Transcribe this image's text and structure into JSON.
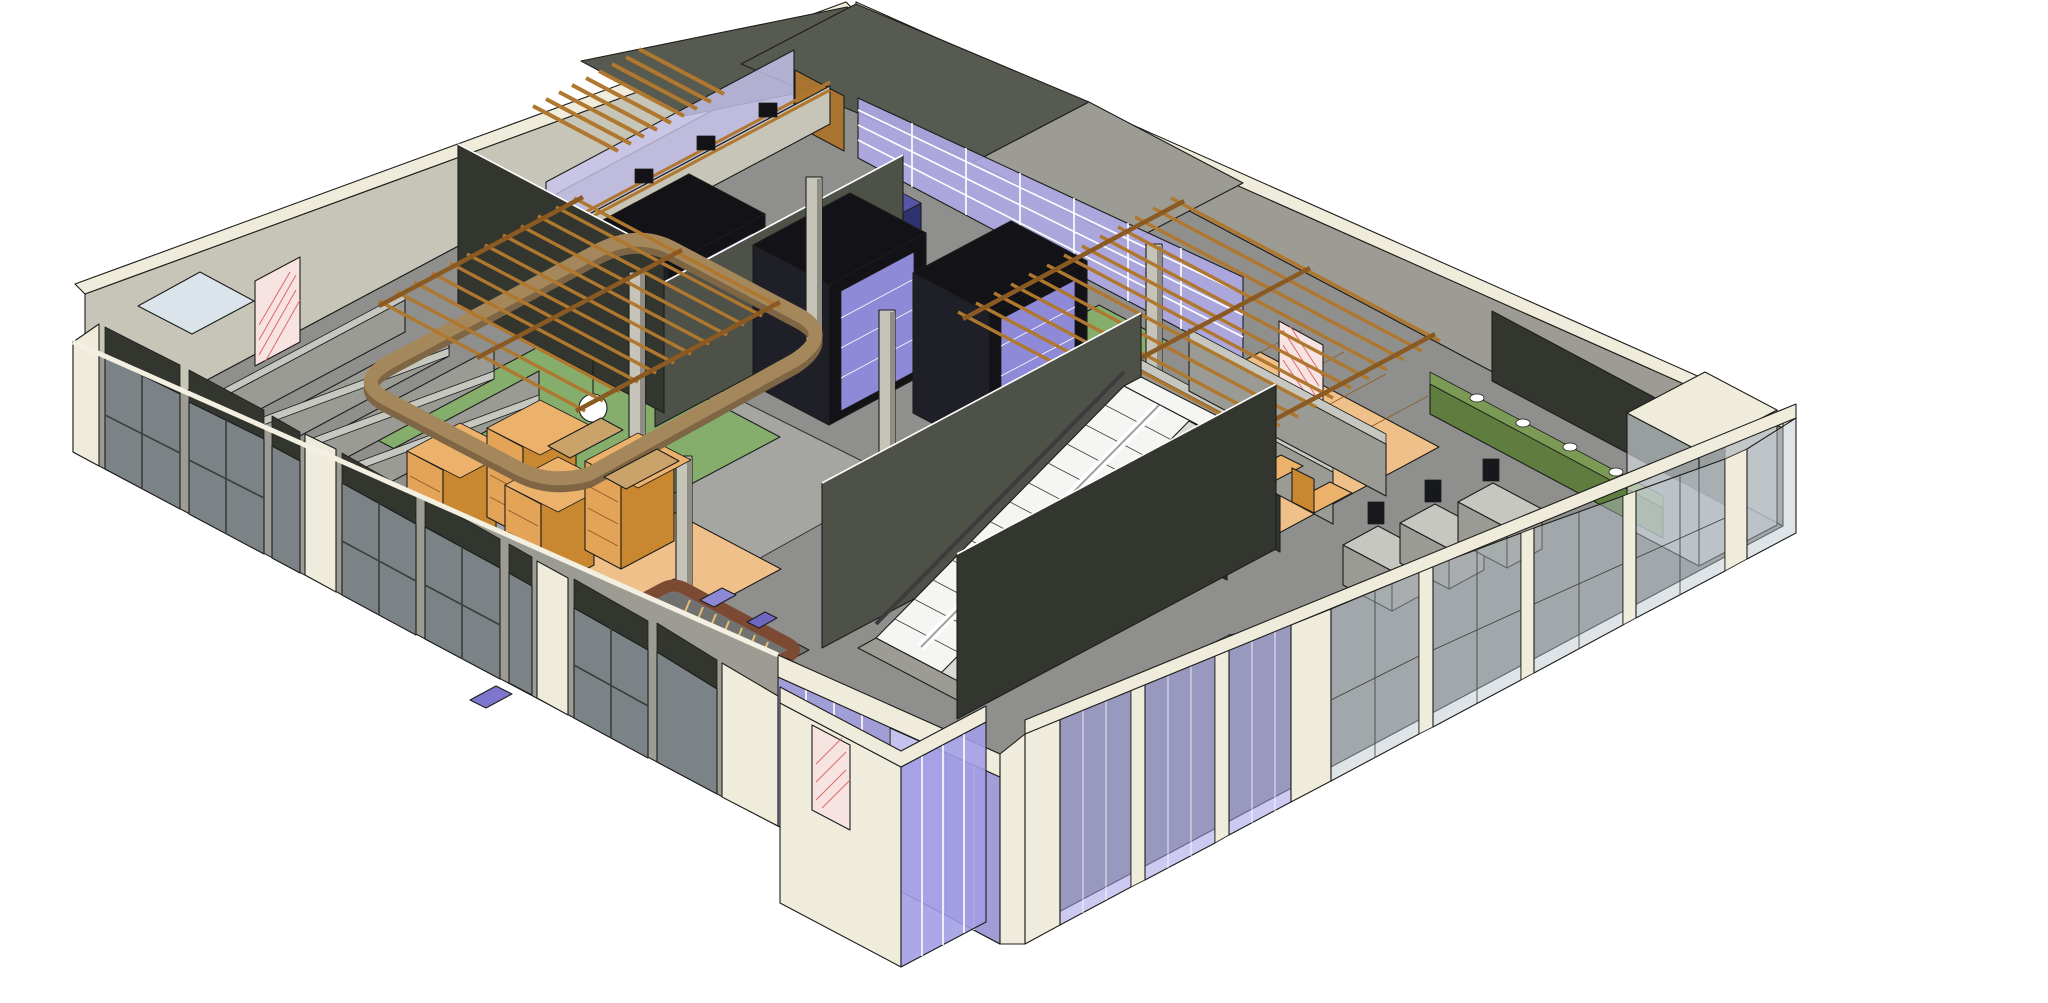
{
  "scene": {
    "background_color": "#ffffff",
    "view": {
      "projection": "axonometric-cutaway",
      "style": "hidden-line-shaded",
      "subject": "single-storey retail interior model"
    },
    "colors": {
      "background": "#ffffff",
      "outline": "#1d1d1b",
      "parapet_cream": "#efecdc",
      "cream_shadow": "#d9d5c0",
      "wall_light": "#c7c5b8",
      "wall_mid": "#9d9c94",
      "wall_dark": "#4d5148",
      "wall_darker": "#33362f",
      "roof_dark": "#565a50",
      "floor": "#8f908e",
      "floor_light": "#a5a6a2",
      "green_floor": "#85ae6d",
      "wood_floor": "#f0c08a",
      "wood_slat": "#b0772e",
      "wood_slat_dark": "#8a5a22",
      "shelf_orange": "#e3a458",
      "shelf_orange_side": "#c9882f",
      "box_orange": "#ecb26b",
      "glass_purple": "#a39ee6",
      "glass_purple_light": "#c9c6f0",
      "glass_blue": "#b7c3cd",
      "glass_pale": "#dde4e9",
      "lavender_panel": "#aeaae6",
      "navy_case": "#2e3270",
      "navy_case_top": "#5556a8",
      "kiosk_black": "#121217",
      "kiosk_side": "#1f1f28",
      "kiosk_glass": "#8f8ad8",
      "ribbon_tan": "#a5875c",
      "ribbon_tan_dark": "#7e6644",
      "balustrade_brown": "#7c4a33",
      "escalator_white": "#f5f5f3",
      "tread_grey": "#d9dad6",
      "counter_green": "#5f7d3f",
      "counter_green_top": "#7a9a55",
      "door_wood": "#a9742f",
      "door_pink": "#f7e4e2",
      "door_pink_hatch": "#d96a6a",
      "column_grey": "#c6c4b8",
      "column_shade": "#908e84",
      "shelf_grey": "#9a9b94",
      "shelf_grey_top": "#c6c7c0",
      "pos_dark": "#17181c",
      "skylight": "#dbe4ea",
      "crate": "#caa36a"
    },
    "elements": [
      {
        "name": "floor-slab",
        "desc": "grey sales-floor slab"
      },
      {
        "name": "parapet-walls",
        "desc": "cream parapet caps around perimeter"
      },
      {
        "name": "northwest-wall",
        "desc": "light grey far wall"
      },
      {
        "name": "back-left-room",
        "desc": "room with stepped shelf rows and pink fire door"
      },
      {
        "name": "stockroom-band",
        "desc": "back-right rooms with dark roofs and lavender glazed wall"
      },
      {
        "name": "wood-door",
        "desc": "brown wood door in back wall"
      },
      {
        "name": "fire-doors",
        "desc": "pink hatched fire-rated doors"
      },
      {
        "name": "bar-counter",
        "desc": "cafe bar counter with espresso machines"
      },
      {
        "name": "slat-canopy",
        "desc": "stepped wood slat canopy"
      },
      {
        "name": "media-kiosks",
        "desc": "black display kiosks with lavender glass shelving"
      },
      {
        "name": "partition-wall",
        "desc": "tall dark partition wall"
      },
      {
        "name": "cafe-ring-soffit",
        "desc": "tan curved soffit band over cafe"
      },
      {
        "name": "pendant-lamp",
        "desc": "white globe pendant light"
      },
      {
        "name": "orange-shelving",
        "desc": "orange box shelving units"
      },
      {
        "name": "pergola-left",
        "desc": "wood slat pergola over green floor"
      },
      {
        "name": "pergola-right",
        "desc": "wood slat pergola over wood floor"
      },
      {
        "name": "green-floor",
        "desc": "green carpet zones"
      },
      {
        "name": "wood-floor",
        "desc": "light wood plank zones"
      },
      {
        "name": "gondola-shelving",
        "desc": "retail gondola shelf rows"
      },
      {
        "name": "escalators",
        "desc": "escalator pair with adjacent stair"
      },
      {
        "name": "stair-opening",
        "desc": "floor opening with brown balustrade and spiral stair"
      },
      {
        "name": "checkout-counters",
        "desc": "POS checkout counters with monitors"
      },
      {
        "name": "restroom-counters",
        "desc": "green vanity counters with sinks and mirror"
      },
      {
        "name": "storefront-southwest",
        "desc": "grey framed storefront glazing with dark shelving behind"
      },
      {
        "name": "storefront-southeast",
        "desc": "purple and blue-grey glass curtain wall"
      },
      {
        "name": "entry-vestibule",
        "desc": "protruding entry block with purple glass and skylight"
      },
      {
        "name": "corner-glass-room",
        "desc": "glass vestibule at east corner"
      },
      {
        "name": "columns",
        "desc": "light grey structural columns"
      },
      {
        "name": "display-cases",
        "desc": "navy blue glass display cases"
      }
    ]
  }
}
